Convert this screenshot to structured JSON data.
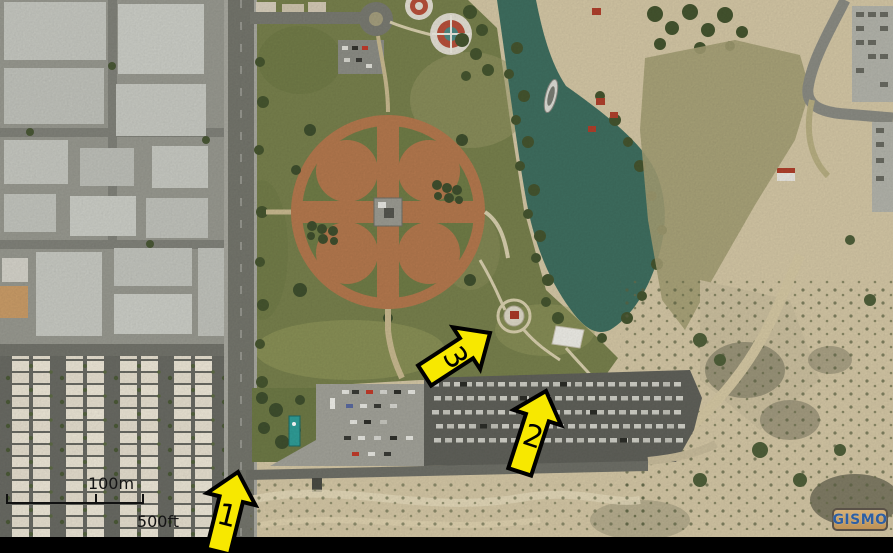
{
  "map": {
    "view_type": "aerial-photo",
    "scale_bar": {
      "metric": "100m",
      "imperial": "500ft"
    },
    "annotations": {
      "arrow_fill": "#f7e800",
      "arrow_outline": "#000000",
      "markers": [
        {
          "label": "1"
        },
        {
          "label": "2"
        },
        {
          "label": "3"
        }
      ]
    },
    "watermark": {
      "label": "GISMO",
      "background": "#c79e62",
      "border_color": "#5a5248",
      "text_color": "#2e5fa3"
    },
    "palette": {
      "lake_water": "#3f6f60",
      "park_grass": "#78814d",
      "ballfield_dirt": "#b5794e",
      "desert_sand": "#d5c8a6",
      "roads": "#75766d",
      "industrial_roofs": "#c7c9c2",
      "residential_roofs": "#eae4d4",
      "letterbox": "#000000"
    }
  }
}
